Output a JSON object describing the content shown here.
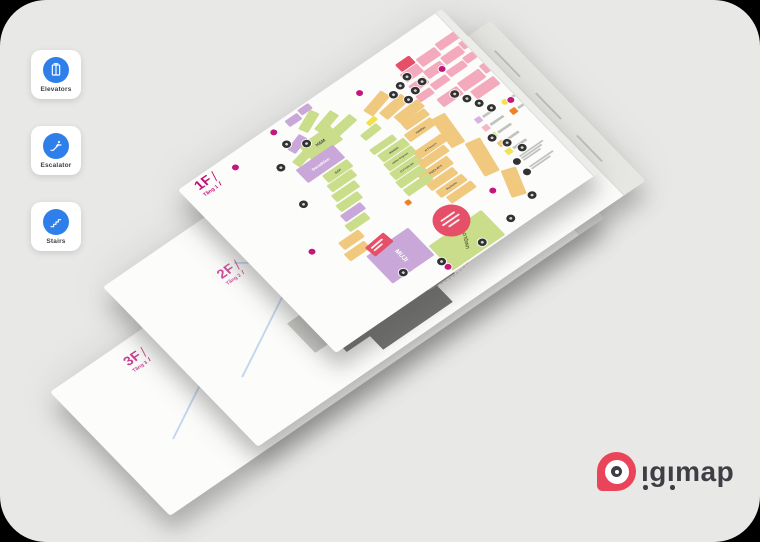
{
  "app": {
    "panel_bg": "#e8e8e7",
    "outside_bg": "#000000"
  },
  "sidebar": {
    "accent": "#2e7fe9",
    "items": [
      {
        "label": "Elevators",
        "icon": "elevator-icon"
      },
      {
        "label": "Escalator",
        "icon": "escalator-icon"
      },
      {
        "label": "Stairs",
        "icon": "stairs-icon"
      }
    ]
  },
  "floors": [
    {
      "label": "1F",
      "sublabel": "Tầng 1"
    },
    {
      "label": "2F",
      "sublabel": "Tầng 2"
    },
    {
      "label": "3F",
      "sublabel": "Tầng 3"
    }
  ],
  "map_1f": {
    "label_color": "#bd1077",
    "stores": [
      {
        "label": "H&M"
      },
      {
        "label": "Decathlon"
      },
      {
        "label": "GAP"
      },
      {
        "label": "MANGO"
      },
      {
        "label": "adidas Originals"
      },
      {
        "label": "COTTON:ON"
      },
      {
        "label": "Haidilao"
      },
      {
        "label": "Al Fresco's"
      },
      {
        "label": "PIZZA 4P'S"
      },
      {
        "label": "Starbucks"
      },
      {
        "label": "MUJI"
      },
      {
        "label": "UNIQLO"
      }
    ],
    "zone_colors": {
      "fashion_pink": "#f3aabd",
      "retail_green": "#cadd8b",
      "dining_tan": "#f0c87e",
      "anchor_purple": "#c9a7d9",
      "event_red": "#e64f68",
      "highlight_yellow": "#f2e14e",
      "atm_orange": "#f08126"
    },
    "legend_swatches": [
      "#d9b3e0",
      "#f5b8c6",
      "#cde08e",
      "#f0c87d",
      "#f0e35a",
      "#f08126"
    ]
  },
  "brand": {
    "name": "Digimap",
    "wordmark_tail": "ıgımap",
    "pin_color": "#e9445a",
    "text_color": "#3e3e44"
  }
}
